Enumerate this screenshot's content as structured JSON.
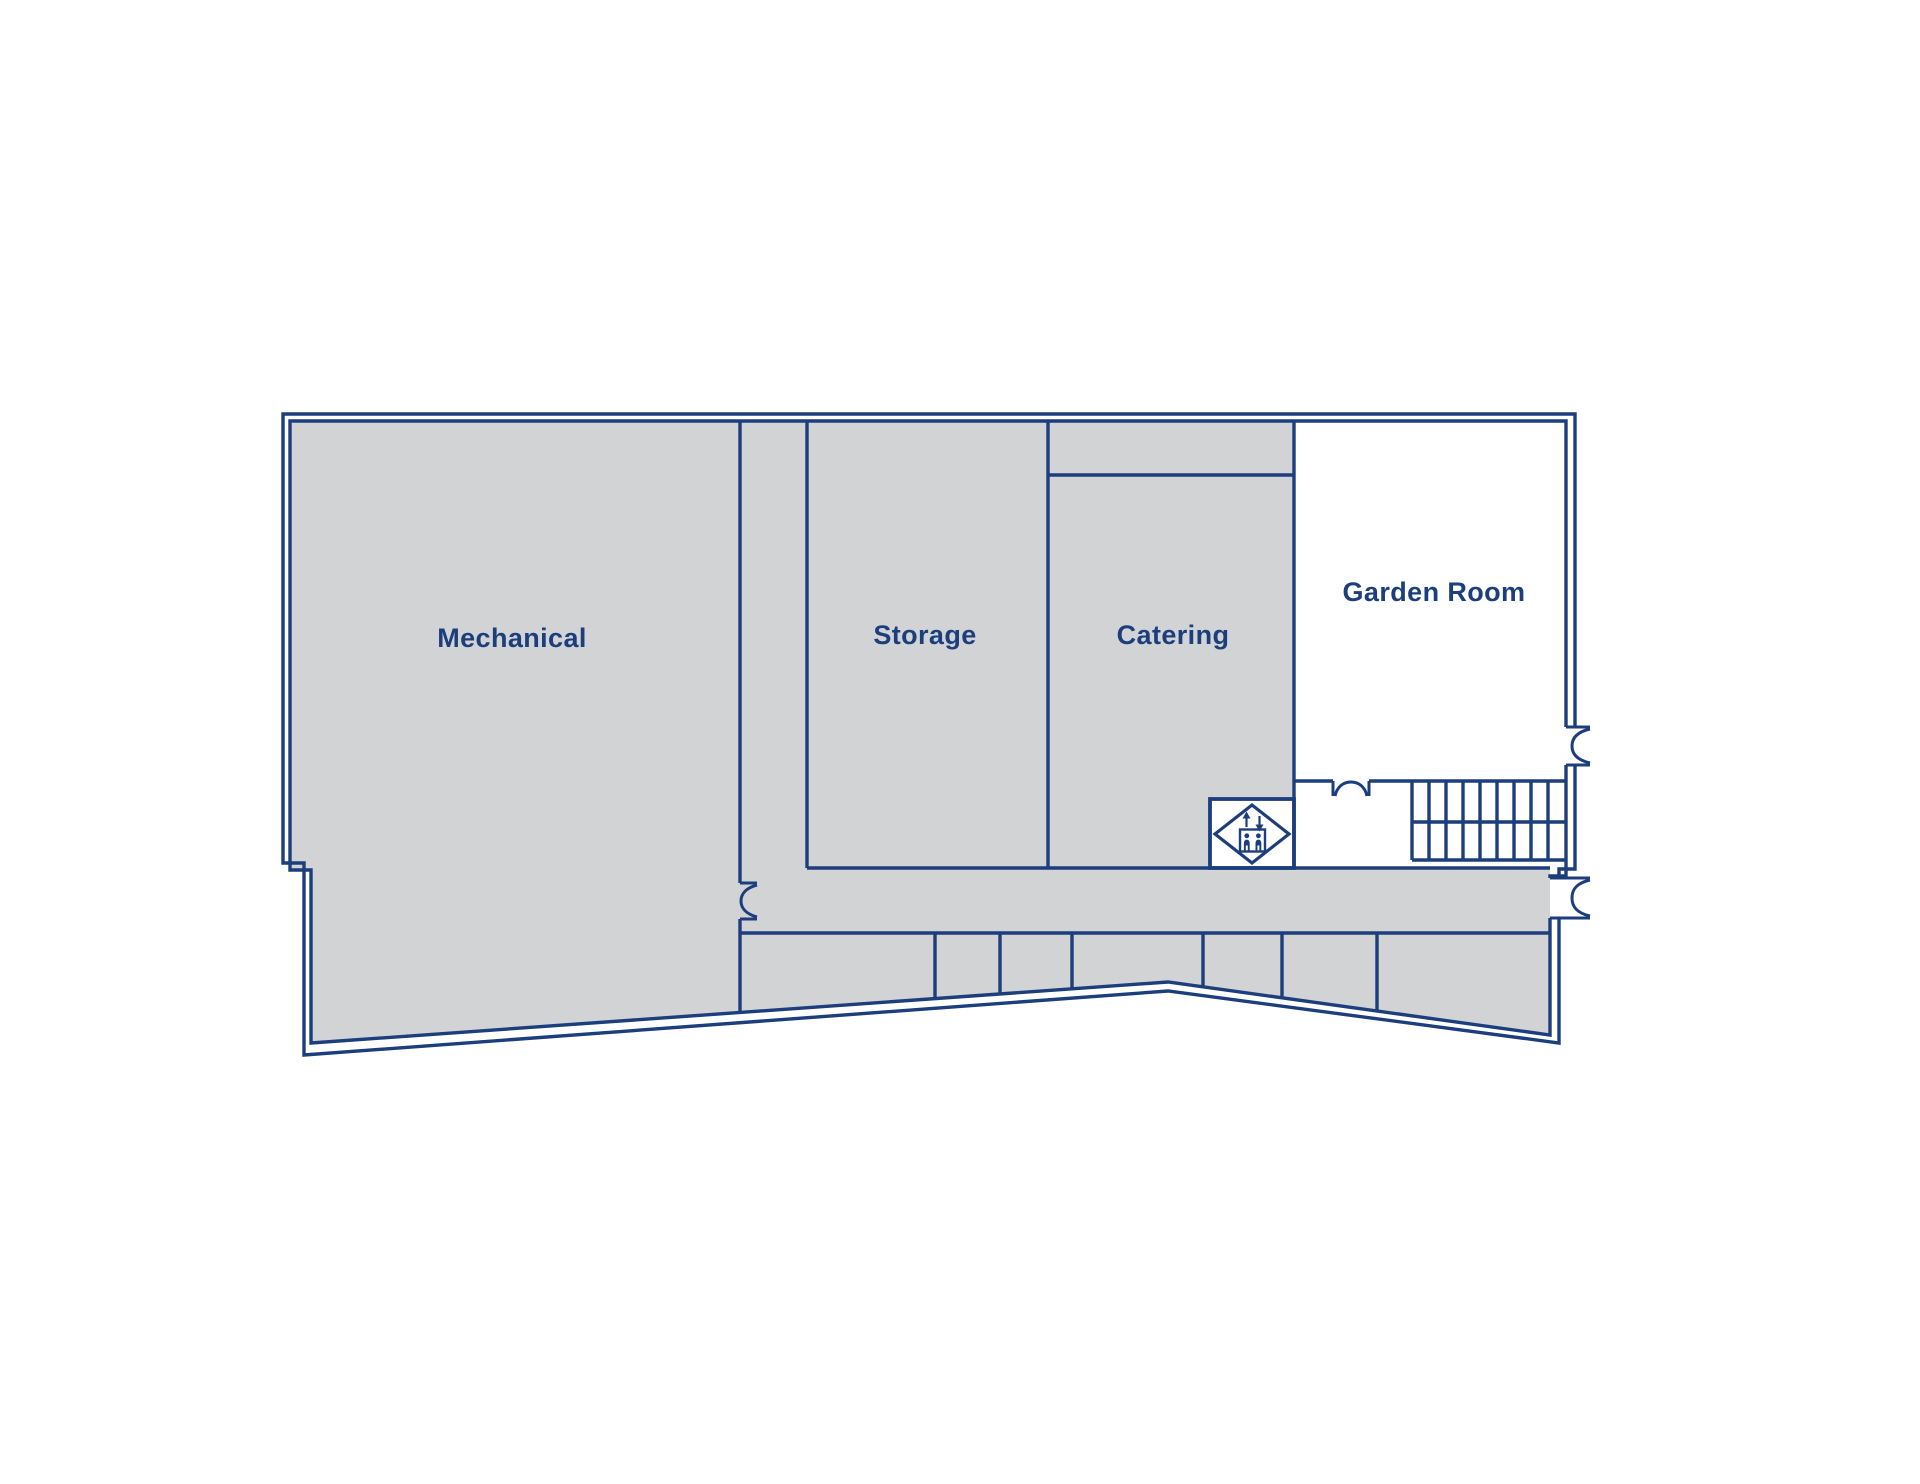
{
  "palette": {
    "wall": "#1c3e7c",
    "fill": "#d2d3d5",
    "label": "#1c3e7c",
    "bg": "#ffffff"
  },
  "floorplan": {
    "rooms": [
      {
        "name": "mechanical",
        "label": "Mechanical"
      },
      {
        "name": "storage",
        "label": "Storage"
      },
      {
        "name": "catering",
        "label": "Catering"
      },
      {
        "name": "garden-room",
        "label": "Garden Room"
      }
    ],
    "icons": [
      {
        "name": "elevator-icon"
      },
      {
        "name": "stairs-icon"
      },
      {
        "name": "door-icon"
      }
    ]
  }
}
